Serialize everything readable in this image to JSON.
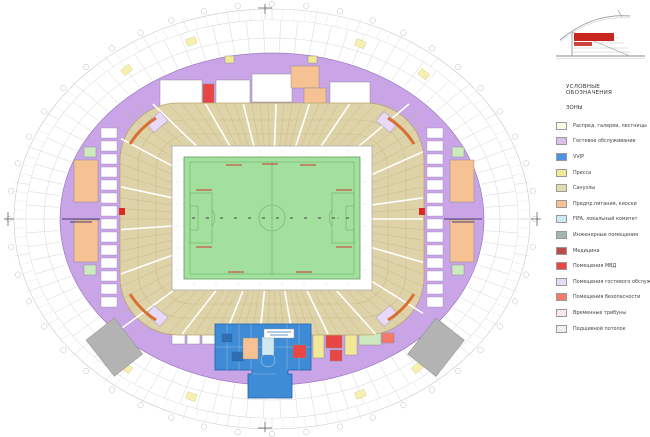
{
  "legend": {
    "title": "УСЛОВНЫЕ ОБОЗНАЧЕНИЯ",
    "subtitle": "ЗОНЫ",
    "items": [
      {
        "label": "Распред. галереи, лестницы",
        "color": "#fdfbe6",
        "hatch": ""
      },
      {
        "label": "Гостевое обслуживание",
        "color": "#d8c0ec",
        "hatch": ""
      },
      {
        "label": "VVIP",
        "color": "#4f94e2",
        "hatch": ""
      },
      {
        "label": "Пресса",
        "color": "#f2e996",
        "hatch": ""
      },
      {
        "label": "Санузлы",
        "color": "#e3dbb2",
        "hatch": ""
      },
      {
        "label": "Предпр.питания, киоски",
        "color": "#f6c193",
        "hatch": ""
      },
      {
        "label": "FIFA, локальный комитет",
        "color": "#cfe8f6",
        "hatch": ""
      },
      {
        "label": "Инженерные помещения",
        "color": "#a4b5b1",
        "hatch": ""
      },
      {
        "label": "Медицина",
        "color": "#bf4a4a",
        "hatch": ""
      },
      {
        "label": "Помещения МВД",
        "color": "#e84545",
        "hatch": ""
      },
      {
        "label": "Помещения гостевого обслуживания",
        "color": "#e9d9f9",
        "hatch": ""
      },
      {
        "label": "Помещения безопасности",
        "color": "#f8796a",
        "hatch": ""
      },
      {
        "label": "Временные трибуны",
        "color": "#ffffff",
        "hatch": "pink"
      },
      {
        "label": "Подшивной потолок",
        "color": "#ffffff",
        "hatch": "gray"
      }
    ]
  },
  "plan": {
    "colors": {
      "concourse": "#c9a4e6",
      "concourse_edge": "#9b7cc0",
      "bowl": "#ded3a8",
      "bowl_edge": "#b9a86f",
      "apron": "#ffffff",
      "field": "#a3e09e",
      "field_line": "#74b871",
      "vvip": "#3f8cd6",
      "vvip_edge": "#1f5fa8",
      "food": "#f6c193",
      "press": "#f2e996",
      "toilets": "#e3dbb2",
      "fifa": "#cfe8f6",
      "engineering": "#a4b5b1",
      "medical": "#bf4a4a",
      "police": "#e84545",
      "guest_room": "#e9d9f9",
      "security": "#f8796a",
      "green_room": "#cdeabf",
      "ramp": "#b3b3b3",
      "grid": "#d9d9d9",
      "marker_red": "#d92b20",
      "section_highlight": "#c8251d"
    }
  }
}
